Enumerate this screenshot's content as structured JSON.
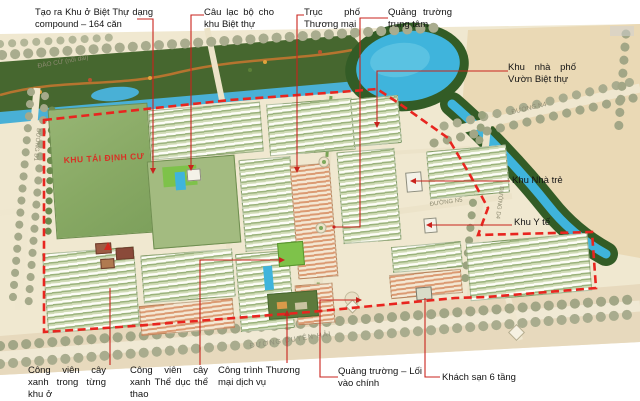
{
  "callouts": {
    "compound_villa": "Tạo ra Khu ở Biệt Thự dạng compound – 164 căn",
    "villa_club": "Câu lạc bộ cho khu Biệt thự",
    "commercial_axis": "Trục phố Thương mại",
    "central_square": "Quảng trường trung tâm",
    "garden_shophouse": "Khu nhà phố Vườn Biệt thự",
    "kindergarten": "Khu Nhà trẻ",
    "medical": "Khu Y tế",
    "neighborhood_park": "Công viên cây xanh trong từng khu ở",
    "sports_park": "Công viên cây xanh Thể dục thể thao",
    "commercial_services": "Công trình Thương mại dịch vụ",
    "entrance_square": "Quảng trường – Lối vào chính",
    "hotel": "Khách sạn 6 tầng"
  },
  "map": {
    "resettlement_zone": "KHU TÁI ĐỊNH CƯ",
    "roads": {
      "dao_cu": "ĐÀO CỪ (nối dài)",
      "n4": "ĐƯỜNG N4",
      "n5": "ĐƯỜNG N5",
      "d4": "ĐƯỜNG D4",
      "d1": "ĐƯỜNG D1",
      "duyen_hai": "ĐƯỜNG DUYÊN HẢI"
    },
    "colors": {
      "boundary": "#e8251f",
      "leader": "#c9231d",
      "water": "#3fb4dc",
      "tree_belt": "#46672f",
      "paper": "#f0e8d0",
      "zone_text": "#d93025"
    }
  }
}
